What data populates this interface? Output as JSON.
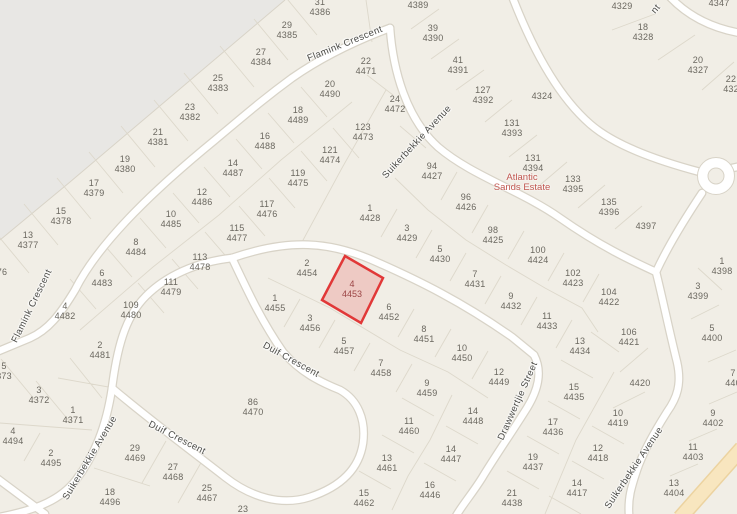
{
  "map": {
    "background": "#f1eee6",
    "out_of_bounds_color": "#e8e7e4",
    "road_fill": "#ffffff",
    "road_casing": "#d8d3c7",
    "parcel_line_color": "#ddd8cb",
    "parcel_label_color": "#6a675f",
    "street_label_color": "#4b4b47",
    "highway_fill": "#f8e6bf",
    "highway_casing": "#ecd3a0"
  },
  "estate": {
    "line1": "Atlantic",
    "line2": "Sands Estate",
    "color": "#c0564f",
    "x": 522,
    "y": 183
  },
  "selection": {
    "lot": "4",
    "erf": "4453",
    "fill": "rgba(228,60,60,0.20)",
    "stroke": "#e13838",
    "label_color": "#9c4545",
    "x": 352,
    "y": 289
  },
  "streets": [
    {
      "label": "Flamink Crescent",
      "x": 345,
      "y": 44,
      "angle": -22
    },
    {
      "label": "Suikerbekkie Avenue",
      "x": 417,
      "y": 142,
      "angle": -47
    },
    {
      "label": "Flamink Crescent",
      "x": 32,
      "y": 306,
      "angle": -64
    },
    {
      "label": "Suikerbekkie Avenue",
      "x": 90,
      "y": 458,
      "angle": -59
    },
    {
      "label": "Duif Crescent",
      "x": 291,
      "y": 360,
      "angle": 29
    },
    {
      "label": "Duif Crescent",
      "x": 177,
      "y": 438,
      "angle": 27
    },
    {
      "label": "Drawwertjie Street",
      "x": 518,
      "y": 401,
      "angle": -66
    },
    {
      "label": "Suikerbekkie Avenue",
      "x": 634,
      "y": 468,
      "angle": -56
    },
    {
      "label": "nt",
      "x": 656,
      "y": 9,
      "angle": -50
    }
  ],
  "parcels": [
    {
      "n": "31",
      "id": "4386",
      "x": 320,
      "y": 7
    },
    {
      "n": "",
      "id": "4389",
      "x": 418,
      "y": 5
    },
    {
      "n": "29",
      "id": "4385",
      "x": 287,
      "y": 30
    },
    {
      "n": "39",
      "id": "4390",
      "x": 433,
      "y": 33
    },
    {
      "n": "27",
      "id": "4384",
      "x": 261,
      "y": 57
    },
    {
      "n": "41",
      "id": "4391",
      "x": 458,
      "y": 65
    },
    {
      "n": "25",
      "id": "4383",
      "x": 218,
      "y": 83
    },
    {
      "n": "22",
      "id": "4471",
      "x": 366,
      "y": 66
    },
    {
      "n": "23",
      "id": "4382",
      "x": 190,
      "y": 112
    },
    {
      "n": "20",
      "id": "4490",
      "x": 330,
      "y": 89
    },
    {
      "n": "24",
      "id": "4472",
      "x": 395,
      "y": 104
    },
    {
      "n": "21",
      "id": "4381",
      "x": 158,
      "y": 137
    },
    {
      "n": "18",
      "id": "4489",
      "x": 298,
      "y": 115
    },
    {
      "n": "123",
      "id": "4473",
      "x": 363,
      "y": 132
    },
    {
      "n": "19",
      "id": "4380",
      "x": 125,
      "y": 164
    },
    {
      "n": "16",
      "id": "4488",
      "x": 265,
      "y": 141
    },
    {
      "n": "121",
      "id": "4474",
      "x": 330,
      "y": 155
    },
    {
      "n": "17",
      "id": "4379",
      "x": 94,
      "y": 188
    },
    {
      "n": "14",
      "id": "4487",
      "x": 233,
      "y": 168
    },
    {
      "n": "119",
      "id": "4475",
      "x": 298,
      "y": 178
    },
    {
      "n": "94",
      "id": "4427",
      "x": 432,
      "y": 171
    },
    {
      "n": "15",
      "id": "4378",
      "x": 61,
      "y": 216
    },
    {
      "n": "12",
      "id": "4486",
      "x": 202,
      "y": 197
    },
    {
      "n": "117",
      "id": "4476",
      "x": 267,
      "y": 209
    },
    {
      "n": "13",
      "id": "4377",
      "x": 28,
      "y": 240
    },
    {
      "n": "10",
      "id": "4485",
      "x": 171,
      "y": 219
    },
    {
      "n": "115",
      "id": "4477",
      "x": 237,
      "y": 233
    },
    {
      "n": "1",
      "id": "4428",
      "x": 370,
      "y": 213
    },
    {
      "n": "96",
      "id": "4426",
      "x": 466,
      "y": 202
    },
    {
      "n": "",
      "id": "76",
      "x": 2,
      "y": 272
    },
    {
      "n": "8",
      "id": "4484",
      "x": 136,
      "y": 247
    },
    {
      "n": "113",
      "id": "4478",
      "x": 200,
      "y": 262
    },
    {
      "n": "3",
      "id": "4429",
      "x": 407,
      "y": 233
    },
    {
      "n": "98",
      "id": "4425",
      "x": 493,
      "y": 235
    },
    {
      "n": "6",
      "id": "4483",
      "x": 102,
      "y": 278
    },
    {
      "n": "111",
      "id": "4479",
      "x": 171,
      "y": 287
    },
    {
      "n": "5",
      "id": "4430",
      "x": 440,
      "y": 254
    },
    {
      "n": "100",
      "id": "4424",
      "x": 538,
      "y": 255
    },
    {
      "n": "4",
      "id": "4482",
      "x": 65,
      "y": 311
    },
    {
      "n": "109",
      "id": "4480",
      "x": 131,
      "y": 310
    },
    {
      "n": "2",
      "id": "4454",
      "x": 307,
      "y": 268
    },
    {
      "n": "7",
      "id": "4431",
      "x": 475,
      "y": 279
    },
    {
      "n": "102",
      "id": "4423",
      "x": 573,
      "y": 278
    },
    {
      "n": "9",
      "id": "4432",
      "x": 511,
      "y": 301
    },
    {
      "n": "104",
      "id": "4422",
      "x": 609,
      "y": 297
    },
    {
      "n": "1",
      "id": "4455",
      "x": 275,
      "y": 303
    },
    {
      "n": "3",
      "id": "4456",
      "x": 310,
      "y": 323
    },
    {
      "n": "6",
      "id": "4452",
      "x": 389,
      "y": 312
    },
    {
      "n": "11",
      "id": "4433",
      "x": 547,
      "y": 321
    },
    {
      "n": "2",
      "id": "4481",
      "x": 100,
      "y": 350
    },
    {
      "n": "5",
      "id": "373",
      "x": 4,
      "y": 371
    },
    {
      "n": "8",
      "id": "4451",
      "x": 424,
      "y": 334
    },
    {
      "n": "13",
      "id": "4434",
      "x": 580,
      "y": 346
    },
    {
      "n": "106",
      "id": "4421",
      "x": 629,
      "y": 337
    },
    {
      "n": "3",
      "id": "4372",
      "x": 39,
      "y": 395
    },
    {
      "n": "1",
      "id": "4371",
      "x": 73,
      "y": 415
    },
    {
      "n": "5",
      "id": "4457",
      "x": 344,
      "y": 346
    },
    {
      "n": "7",
      "id": "4458",
      "x": 381,
      "y": 368
    },
    {
      "n": "10",
      "id": "4450",
      "x": 462,
      "y": 353
    },
    {
      "n": "",
      "id": "4420",
      "x": 640,
      "y": 383
    },
    {
      "n": "86",
      "id": "4470",
      "x": 253,
      "y": 407
    },
    {
      "n": "12",
      "id": "4449",
      "x": 499,
      "y": 377
    },
    {
      "n": "9",
      "id": "4459",
      "x": 427,
      "y": 388
    },
    {
      "n": "15",
      "id": "4435",
      "x": 574,
      "y": 392
    },
    {
      "n": "4",
      "id": "4494",
      "x": 13,
      "y": 436
    },
    {
      "n": "2",
      "id": "4495",
      "x": 51,
      "y": 458
    },
    {
      "n": "11",
      "id": "4460",
      "x": 409,
      "y": 426
    },
    {
      "n": "14",
      "id": "4448",
      "x": 473,
      "y": 416
    },
    {
      "n": "17",
      "id": "4436",
      "x": 553,
      "y": 427
    },
    {
      "n": "10",
      "id": "4419",
      "x": 618,
      "y": 418
    },
    {
      "n": "29",
      "id": "4469",
      "x": 135,
      "y": 453
    },
    {
      "n": "27",
      "id": "4468",
      "x": 173,
      "y": 472
    },
    {
      "n": "13",
      "id": "4461",
      "x": 387,
      "y": 463
    },
    {
      "n": "14",
      "id": "4447",
      "x": 451,
      "y": 454
    },
    {
      "n": "19",
      "id": "4437",
      "x": 533,
      "y": 462
    },
    {
      "n": "12",
      "id": "4418",
      "x": 598,
      "y": 453
    },
    {
      "n": "25",
      "id": "4467",
      "x": 207,
      "y": 493
    },
    {
      "n": "18",
      "id": "4496",
      "x": 110,
      "y": 497
    },
    {
      "n": "15",
      "id": "4462",
      "x": 364,
      "y": 498
    },
    {
      "n": "16",
      "id": "4446",
      "x": 430,
      "y": 490
    },
    {
      "n": "21",
      "id": "4438",
      "x": 512,
      "y": 498
    },
    {
      "n": "14",
      "id": "4417",
      "x": 577,
      "y": 488
    },
    {
      "n": "23",
      "id": "",
      "x": 243,
      "y": 509
    },
    {
      "n": "1",
      "id": "4398",
      "x": 722,
      "y": 266
    },
    {
      "n": "3",
      "id": "4399",
      "x": 698,
      "y": 291
    },
    {
      "n": "5",
      "id": "4400",
      "x": 712,
      "y": 333
    },
    {
      "n": "7",
      "id": "440",
      "x": 733,
      "y": 378
    },
    {
      "n": "9",
      "id": "4402",
      "x": 713,
      "y": 418
    },
    {
      "n": "11",
      "id": "4403",
      "x": 693,
      "y": 452
    },
    {
      "n": "13",
      "id": "4404",
      "x": 674,
      "y": 488
    },
    {
      "n": "",
      "id": "4329",
      "x": 622,
      "y": 6
    },
    {
      "n": "18",
      "id": "4328",
      "x": 643,
      "y": 32
    },
    {
      "n": "20",
      "id": "4327",
      "x": 698,
      "y": 65
    },
    {
      "n": "22",
      "id": "432",
      "x": 731,
      "y": 84
    },
    {
      "n": "",
      "id": "4347",
      "x": 719,
      "y": 3
    },
    {
      "n": "",
      "id": "4324",
      "x": 542,
      "y": 96
    },
    {
      "n": "127",
      "id": "4392",
      "x": 483,
      "y": 95
    },
    {
      "n": "131",
      "id": "4393",
      "x": 512,
      "y": 128
    },
    {
      "n": "131",
      "id": "4394",
      "x": 533,
      "y": 163
    },
    {
      "n": "133",
      "id": "4395",
      "x": 573,
      "y": 184
    },
    {
      "n": "135",
      "id": "4396",
      "x": 609,
      "y": 207
    },
    {
      "n": "",
      "id": "4397",
      "x": 646,
      "y": 226
    }
  ]
}
